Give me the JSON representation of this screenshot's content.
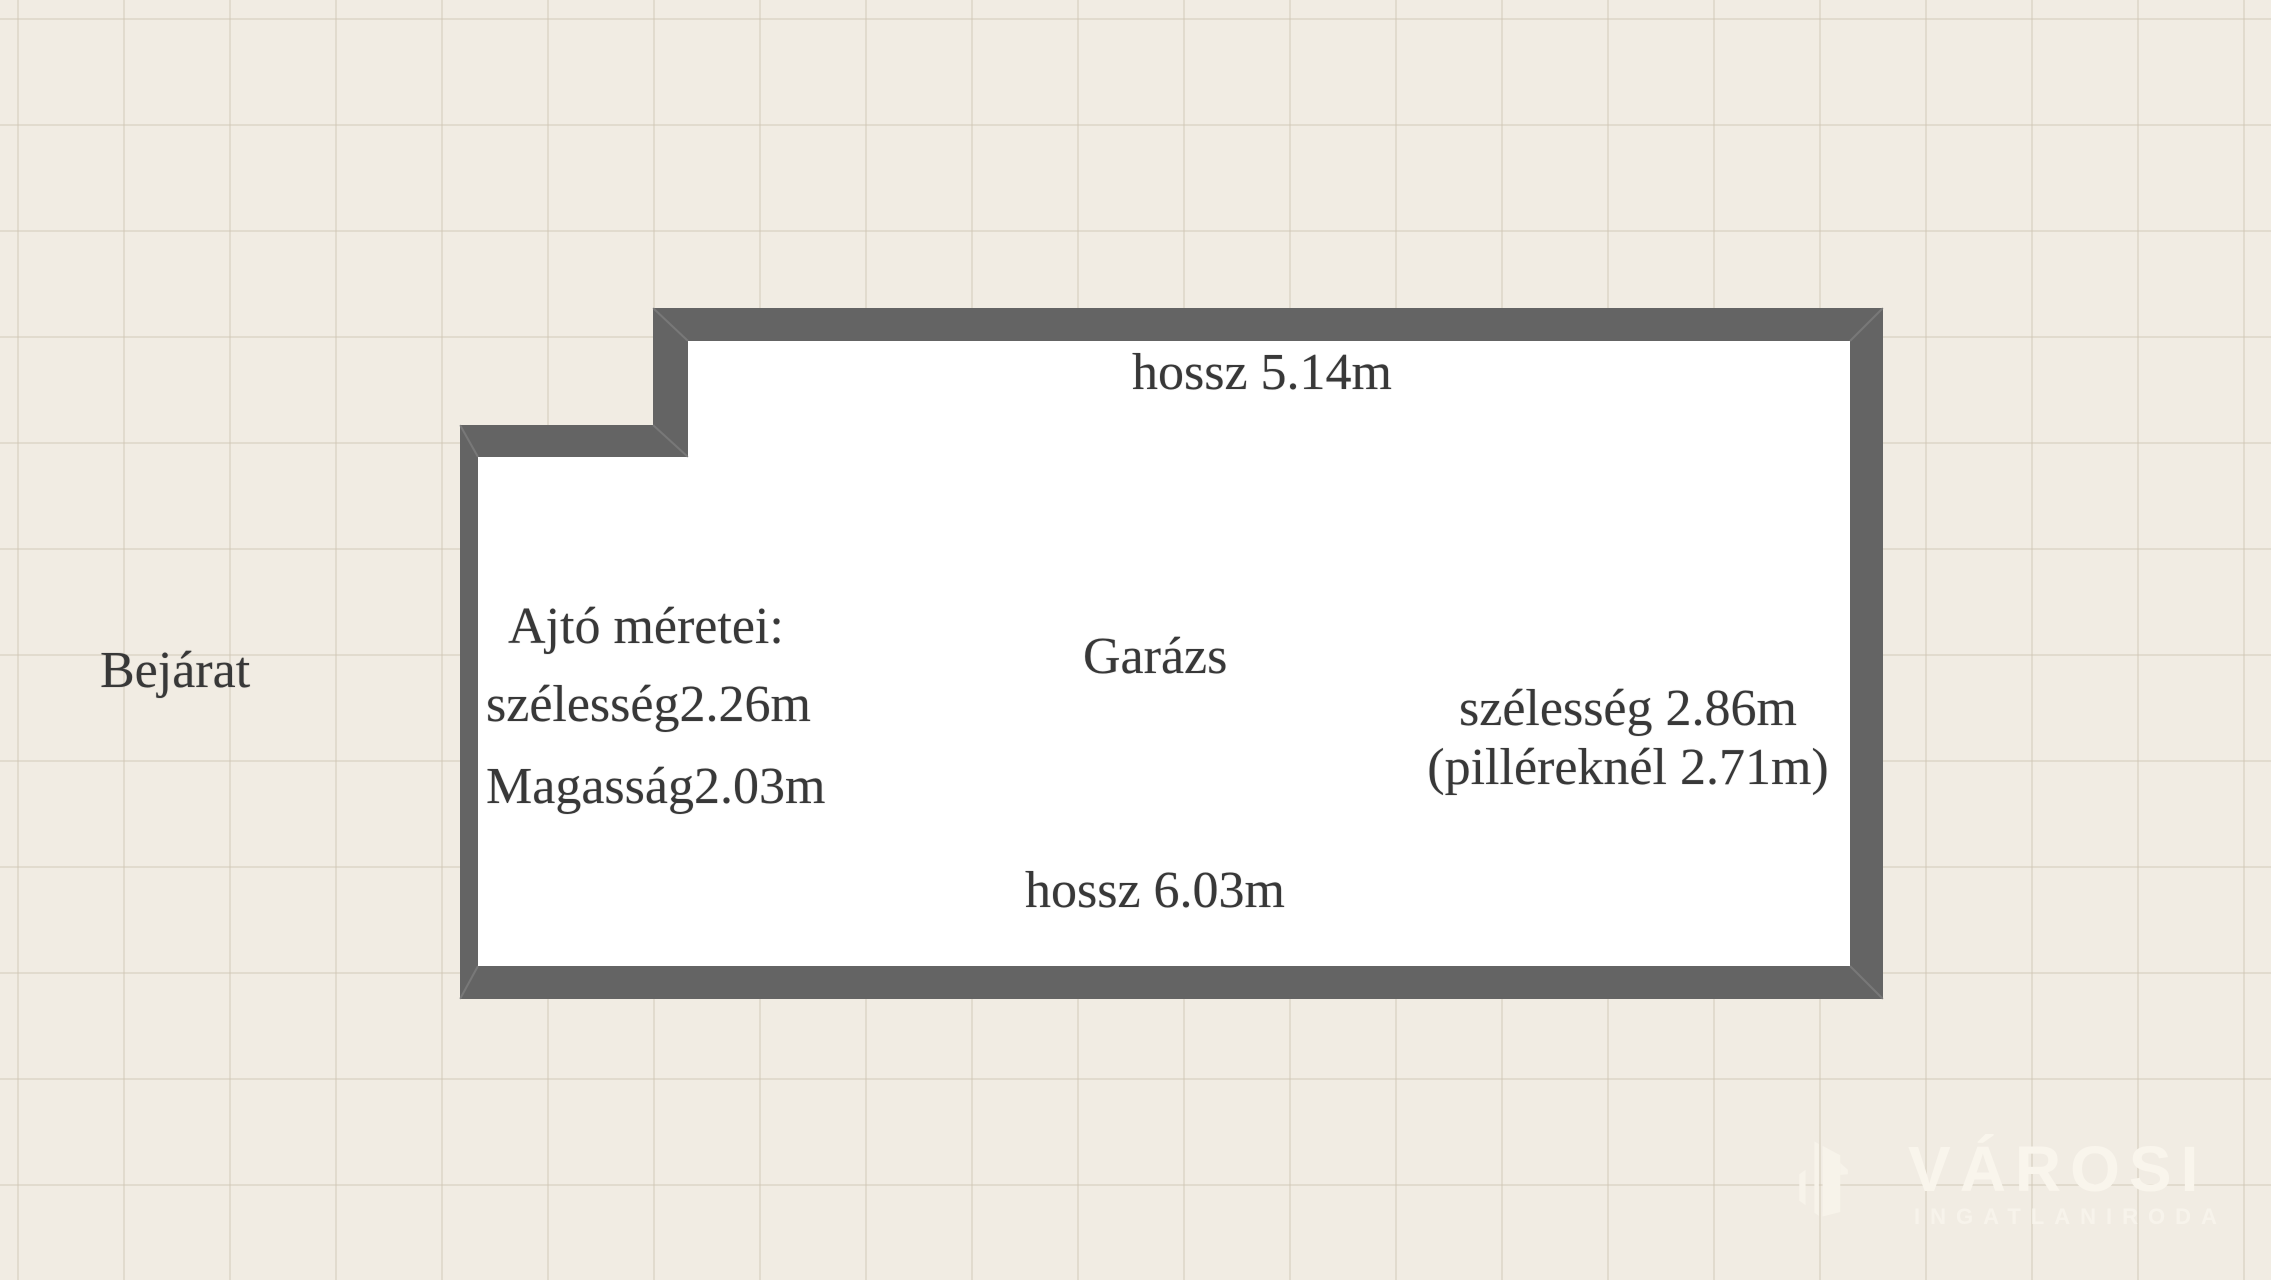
{
  "colors": {
    "background": "#f1ece3",
    "grid_line": "#d9d1c0",
    "wall": "#646464",
    "room_fill": "#ffffff",
    "label_text": "#383838",
    "watermark": "#f9f5ec"
  },
  "floorplan": {
    "room_label": "Garázs",
    "entrance_label": "Bejárat",
    "top_wall_label": "hossz 5.14m",
    "bottom_wall_label": "hossz 6.03m",
    "right_wall_label_line1": "szélesség 2.86m",
    "right_wall_label_line2": "(pilléreknél 2.71m)",
    "door_info": {
      "title": "Ajtó méretei:",
      "width": "szélesség2.26m",
      "height": "Magasság2.03m"
    }
  },
  "watermark": {
    "icon": "buildings-icon",
    "brand": "VÁROSI",
    "subtitle": "INGATLANIRODA"
  }
}
